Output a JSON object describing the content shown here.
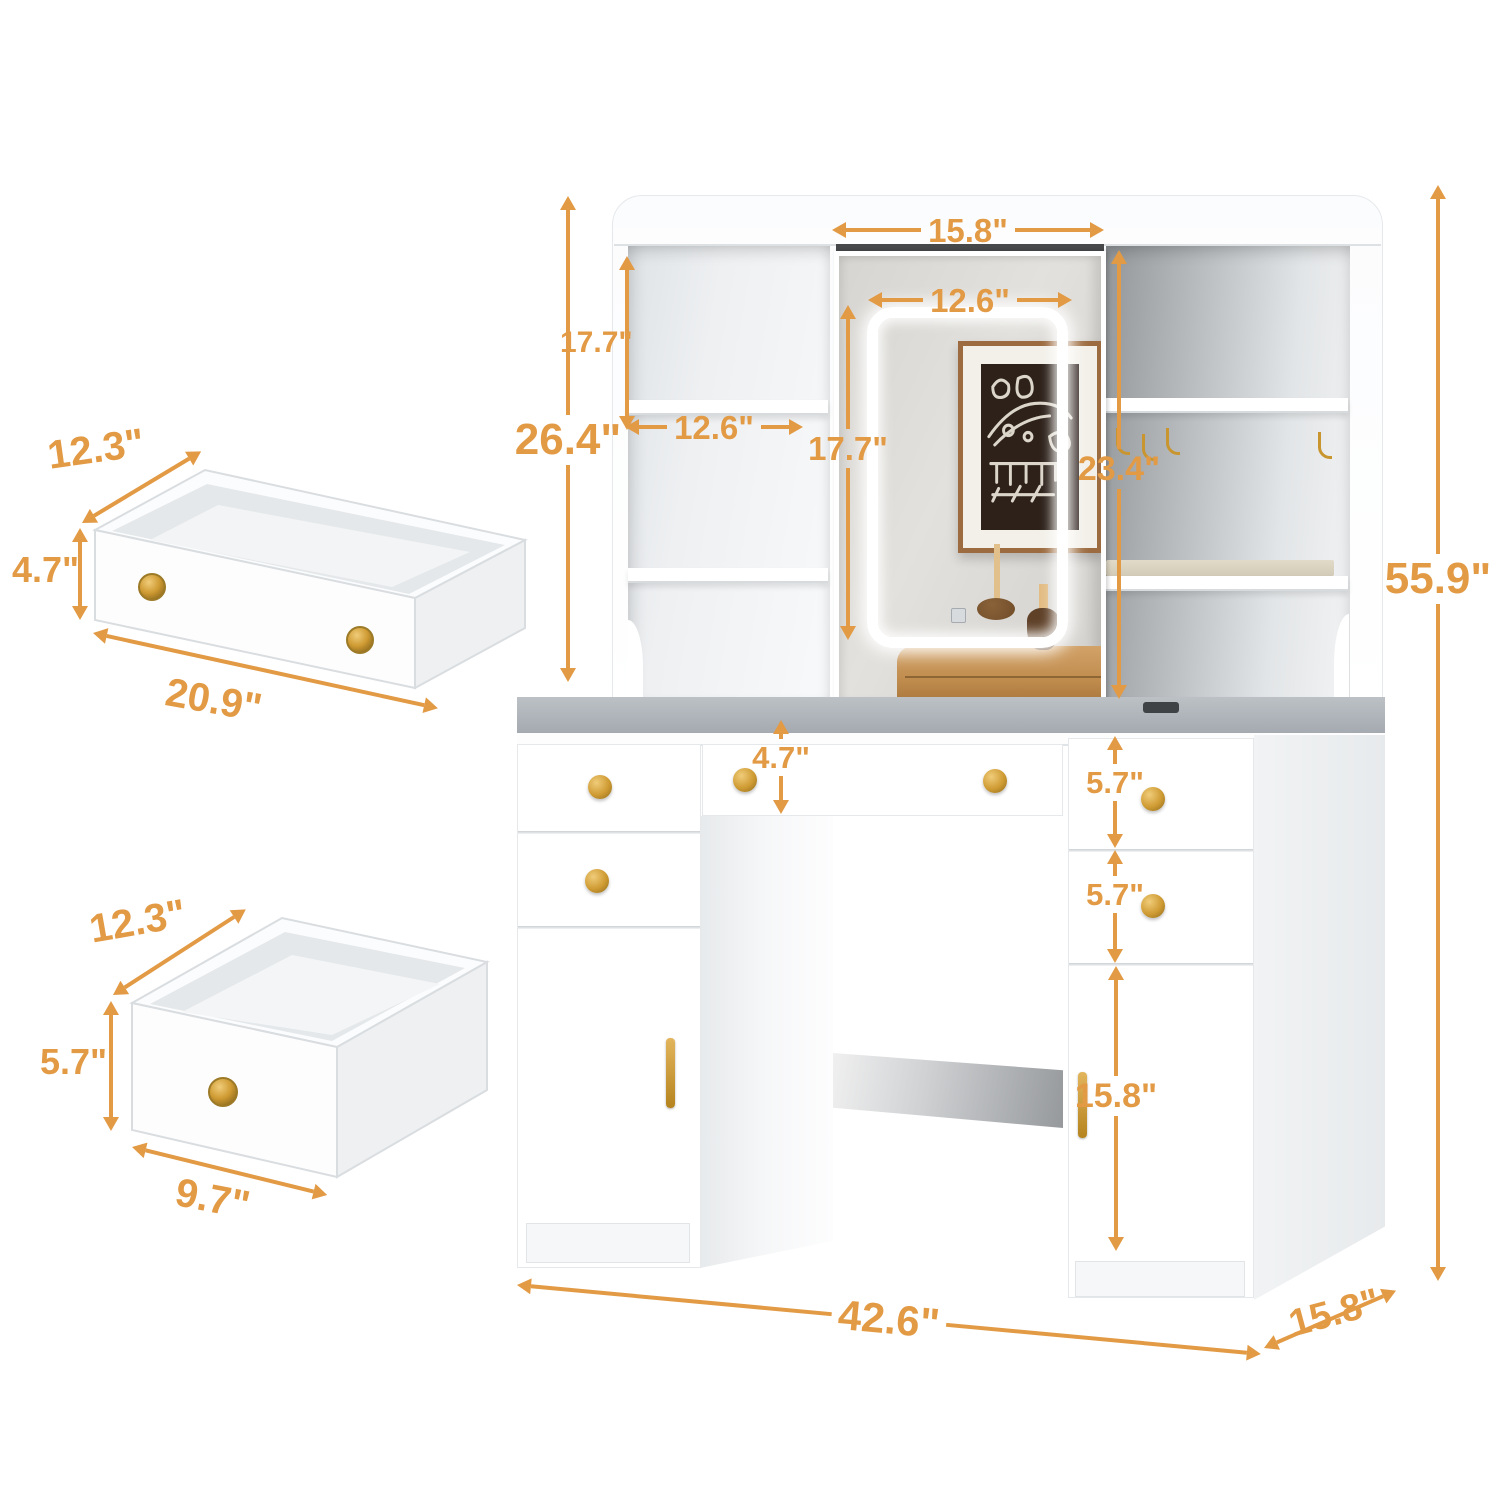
{
  "meta": {
    "accent_color": "#E29A45",
    "hardware_color": "#C9952E",
    "unit": "inches",
    "subject": "vanity desk with LED mirror, hutch shelves and drawers - dimension diagram"
  },
  "dimensions": {
    "hutch_top_width": "15.8\"",
    "led_width": "12.6\"",
    "left_shelf_section_height": "17.7\"",
    "left_shelf_width": "12.6\"",
    "hutch_height": "26.4\"",
    "led_height": "17.7\"",
    "mirror_height": "23.4\"",
    "overall_height": "55.9\"",
    "center_drawer_height": "4.7\"",
    "right_top_drawer_height": "5.7\"",
    "right_middle_drawer_height": "5.7\"",
    "right_cabinet_height": "15.8\"",
    "overall_width": "42.6\"",
    "overall_depth": "15.8\"",
    "large_drawer": {
      "depth": "12.3\"",
      "height": "4.7\"",
      "width": "20.9\""
    },
    "small_drawer": {
      "depth": "12.3\"",
      "height": "5.7\"",
      "width": "9.7\""
    }
  }
}
